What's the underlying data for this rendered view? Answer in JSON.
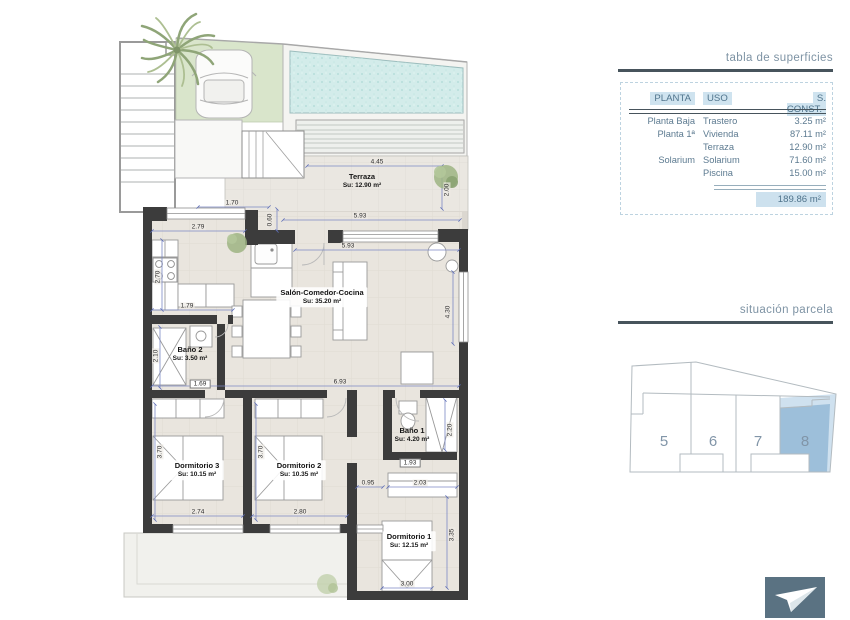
{
  "plan": {
    "rooms": {
      "terraza": {
        "name": "Terraza",
        "area": "Su: 12.90 m²"
      },
      "salon": {
        "name": "Salón-Comedor-Cocina",
        "area": "Su: 35.20 m²"
      },
      "bano2": {
        "name": "Baño 2",
        "area": "Su: 3.50 m²"
      },
      "bano1": {
        "name": "Baño 1",
        "area": "Su: 4.20 m²"
      },
      "dorm3": {
        "name": "Dormitorio 3",
        "area": "Su: 10.15 m²"
      },
      "dorm2": {
        "name": "Dormitorio 2",
        "area": "Su: 10.35 m²"
      },
      "dorm1": {
        "name": "Dormitorio 1",
        "area": "Su: 12.15 m²"
      }
    },
    "dims": {
      "d445": "4.45",
      "d200": "2.00",
      "d170": "1.70",
      "d060": "0.60",
      "d593_terraza": "5.93",
      "d593_salon": "5.93",
      "d279": "2.79",
      "d270": "2.70",
      "d179": "1.79",
      "d210": "2.10",
      "d169": "1.69",
      "d430": "4.30",
      "d693": "6.93",
      "d370_d3": "3.70",
      "d274": "2.74",
      "d370_d2": "3.70",
      "d280": "2.80",
      "d095": "0.95",
      "d203": "2.03",
      "d193": "1.93",
      "d220": "2.20",
      "d335": "3.35",
      "d300": "3.00"
    }
  },
  "surfaces_table": {
    "title": "tabla de superficies",
    "headers": [
      "PLANTA",
      "USO",
      "S. CONST."
    ],
    "rows": [
      [
        "Planta Baja",
        "Trastero",
        "3.25 m²"
      ],
      [
        "Planta 1ª",
        "Vivienda",
        "87.11 m²"
      ],
      [
        "",
        "Terraza",
        "12.90 m²"
      ],
      [
        "Solarium",
        "Solarium",
        "71.60 m²"
      ],
      [
        "",
        "Piscina",
        "15.00 m²"
      ]
    ],
    "total": "189.86 m²"
  },
  "parcela": {
    "title": "situación parcela",
    "units": [
      "5",
      "6",
      "7",
      "8"
    ],
    "highlighted_unit": "8"
  },
  "colors": {
    "wall": "#3c3c3c",
    "pool": "#d3ecea",
    "garden": "#d9e5cb",
    "table_highlight": "#cfe3ef",
    "table_text": "#5c7a90",
    "rule_slate": "#47545c",
    "plot_highlight": "#9dbfda",
    "logo_bg": "#5a7282"
  }
}
